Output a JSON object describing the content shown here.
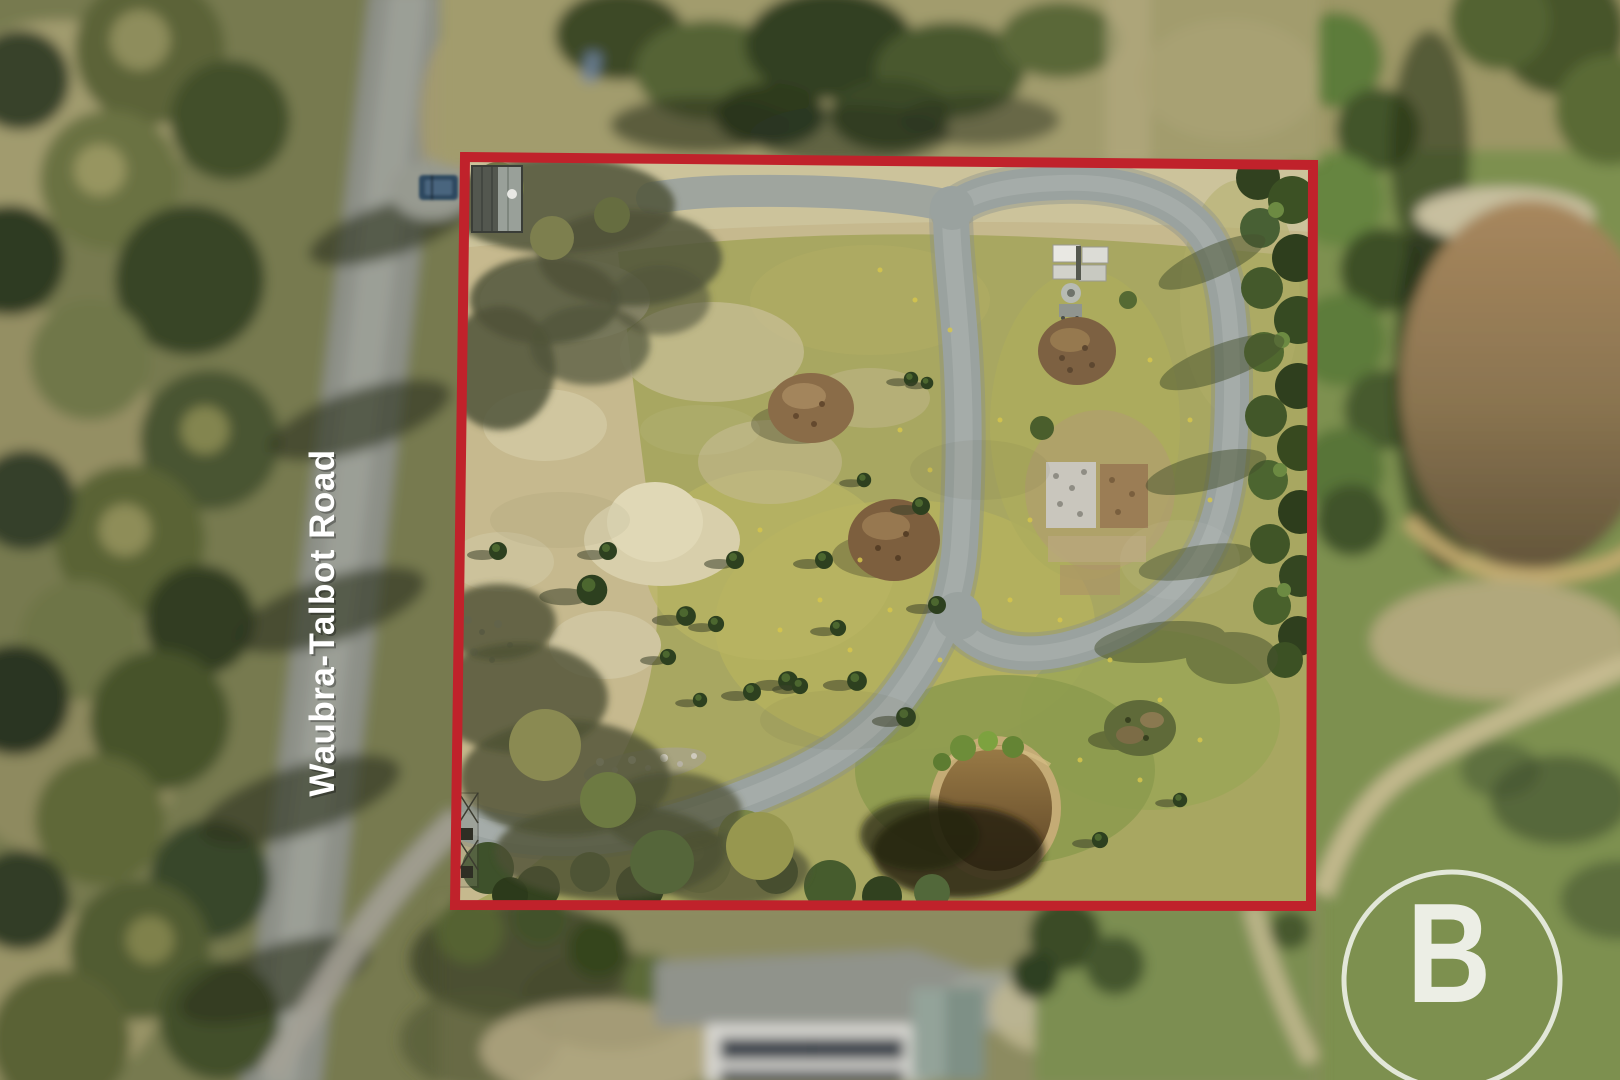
{
  "photo": {
    "kind": "aerial-drone-photo-of-rural-property-lot",
    "road_label": "Waubra-Talbot Road",
    "watermark": {
      "letter": "B"
    },
    "colors": {
      "boundary_red": "#c0222b",
      "watermark_white": "#ffffff",
      "label_white": "#ffffff"
    }
  }
}
